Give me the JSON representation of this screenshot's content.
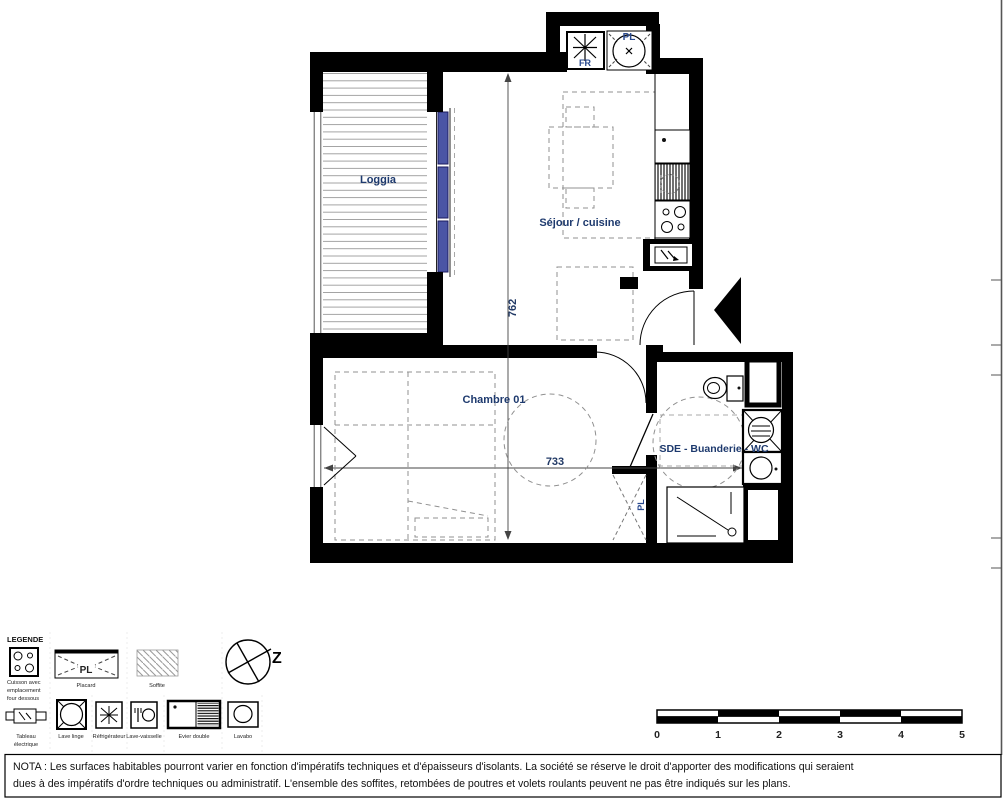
{
  "plan": {
    "room_labels": {
      "loggia": "Loggia",
      "sejour": "Séjour / cuisine",
      "chambre": "Chambre 01",
      "sde": "SDE - Buanderie - WC"
    },
    "dimensions": {
      "vertical": "762",
      "horizontal": "733"
    },
    "symbols": {
      "fridge": "FR",
      "placard_top": "PL",
      "placard_chambre": "PL"
    }
  },
  "legend": {
    "title": "LEGENDE",
    "cuisson_lines": [
      "Cuisson avec",
      "emplacement",
      "four dessous"
    ],
    "placard_label": "Placard",
    "placard_symbol": "PL",
    "soffite_label": "Soffite",
    "north_letter": "Z",
    "tableau_lines": [
      "Tableau",
      "électrique"
    ],
    "lave_linge_label": "Lave linge",
    "refrigerateur_label": "Réfrigérateur",
    "lave_vaisselle_label": "Lave-vaisselle",
    "evier_label": "Evier double",
    "lavabo_label": "Lavabo"
  },
  "scale_bar": {
    "labels": [
      "0",
      "1",
      "2",
      "3",
      "4",
      "5"
    ]
  },
  "nota": {
    "line1": "NOTA : Les surfaces habitables pourront varier en fonction d'impératifs techniques et d'épaisseurs d'isolants. La société se réserve le droit d'apporter des modifications qui seraient",
    "line2": "dues à des impératifs d'ordre techniques ou administratif. L'ensemble des soffites, retombées de poutres et volets roulants peuvent ne pas être indiqués sur les plans."
  },
  "colors": {
    "wall": "#000000",
    "label": "#1e3a6e",
    "window_blue": "#4a55a5",
    "dash": "#909090"
  }
}
